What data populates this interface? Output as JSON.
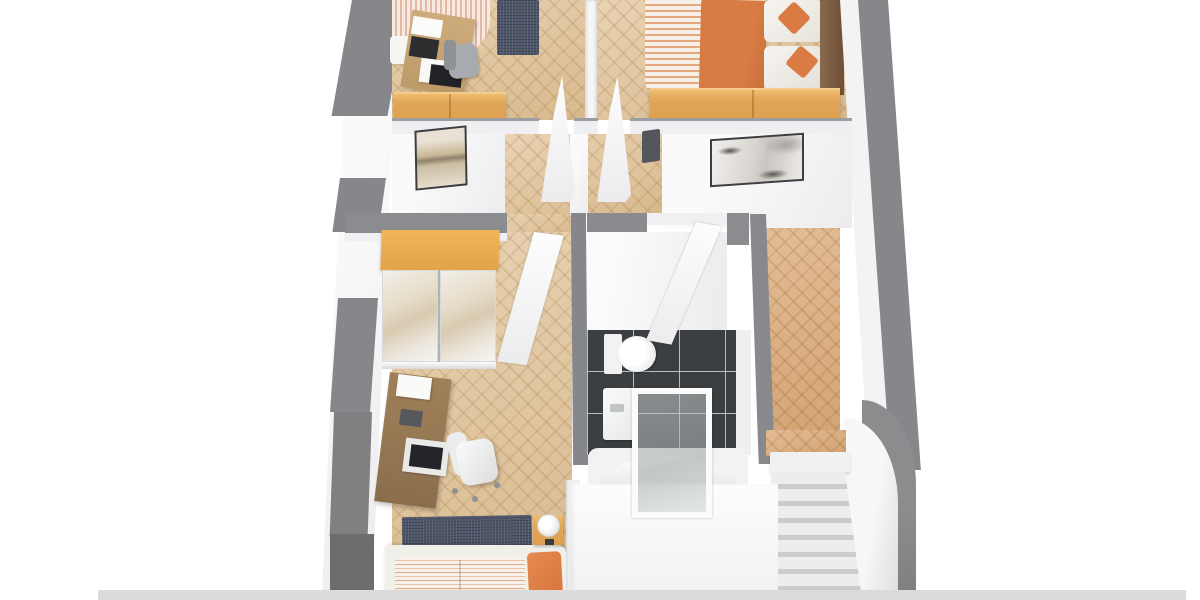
{
  "scene": {
    "type": "3d-floor-plan-render",
    "view": "cutaway top-down isometric render of an upper residential floor",
    "background": "#ffffff",
    "visible_text": ""
  },
  "palette": {
    "exterior_wall_gray": "#85878a",
    "exterior_wall_gray_dark": "#6b6d6f",
    "interior_wall_white": "#f4f4f5",
    "parquet_light": "#e0c296",
    "parquet_warm": "#dcab79",
    "oak_furniture": "#e2a657",
    "walnut_desk": "#8e7350",
    "navy_rug": "#4d5568",
    "accent_orange": "#d87c45",
    "duvet_stripe_pink": "#e9c2aa",
    "bathroom_tile": "#3c3f42",
    "tile_grout": "#caccd0",
    "stair_tread": "#ededee",
    "stair_riser": "#c8c9cb",
    "headboard_wood": "#7a5a41"
  },
  "rooms": [
    {
      "id": "bedroom-top-left",
      "floor": "parquet-light",
      "furniture": [
        "striped-single-bed",
        "wood-desk",
        "papers",
        "printer",
        "desk-chair",
        "navy-rug",
        "oak-sideboard",
        "framed-picture-beige"
      ]
    },
    {
      "id": "bedroom-top-right",
      "floor": "parquet-light",
      "furniture": [
        "double-bed-striped",
        "orange-throw-blanket",
        "white-pillows",
        "orange-accent-cushions",
        "dark-wood-headboard",
        "oak-foot-bench",
        "framed-picture-gray"
      ]
    },
    {
      "id": "hallway-center",
      "floor": "parquet-light",
      "furniture": [
        "open-door-bedroom-top-left",
        "open-door-bedroom-top-right",
        "wall-radiator"
      ]
    },
    {
      "id": "bedroom-bottom-left",
      "floor": "parquet-light",
      "furniture": [
        "mirrored-wardrobe-oak-top",
        "open-door",
        "walnut-desk",
        "paper-stack",
        "open-laptop",
        "white-office-chair",
        "navy-rug",
        "double-bed-striped",
        "orange-pillow",
        "oak-nightstand",
        "white-table-lamp"
      ]
    },
    {
      "id": "bathroom",
      "floor": "dark-tiles",
      "furniture": [
        "toilet",
        "wall-sink",
        "glass-shower-screen",
        "bathtub",
        "open-door"
      ]
    },
    {
      "id": "landing-right",
      "floor": "parquet-warm",
      "furniture": [
        "staircase-down",
        "curved-balustrade-wall"
      ]
    }
  ]
}
